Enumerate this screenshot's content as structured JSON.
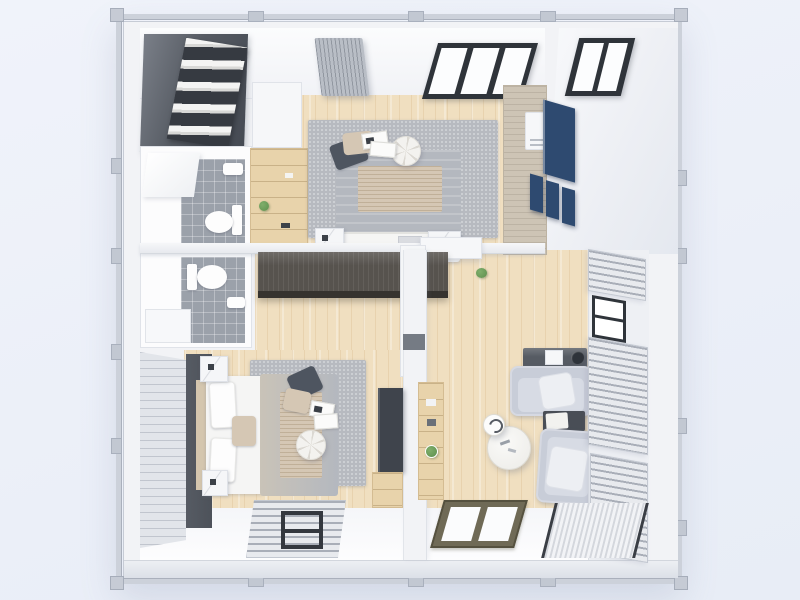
{
  "scene": {
    "title": "Top-view 3D floor plan render of a two-bedroom container home",
    "view": "top-down 3d architectural render, no visible text",
    "rooms": [
      {
        "id": "bedroom-1",
        "label": "Bedroom 1 (top)",
        "floor": "light wood planks",
        "furniture": [
          "double bed with gray duvet",
          "gray area rug",
          "round white pouf",
          "open magazines",
          "two nightstands",
          "white wall cabinet",
          "wood shelf unit with plant",
          "wood desk",
          "navy wall panel",
          "navy cube shelves",
          "white mini fridge",
          "ceiling AC unit",
          "dark-framed top window"
        ]
      },
      {
        "id": "walk-in-closet",
        "label": "Walk-in closet (top-left)",
        "furniture": [
          "dark wardrobe with folded white linens"
        ]
      },
      {
        "id": "bathroom-1",
        "label": "Bathroom 1 (upper-left)",
        "floor": "gray tile",
        "furniture": [
          "toilet",
          "wash basin",
          "open white door"
        ]
      },
      {
        "id": "bathroom-2",
        "label": "Bathroom 2 (mid-left)",
        "floor": "gray tile",
        "furniture": [
          "toilet",
          "wash basin",
          "shower tray"
        ]
      },
      {
        "id": "bedroom-2",
        "label": "Bedroom 2 (bottom-left)",
        "floor": "light wood planks",
        "furniture": [
          "double bed with white and gray bedding",
          "gray area rug",
          "round white pouf",
          "open magazines",
          "two marble-top nightstands",
          "dark accent headboard wall",
          "blinded window wall",
          "TV panel",
          "low wood cabinet",
          "striped floor mat with dark frame"
        ]
      },
      {
        "id": "living-room",
        "label": "Living room (bottom-right)",
        "floor": "light wood planks",
        "furniture": [
          "two facing light-gray loveseats",
          "dark side table with marble cushion",
          "round marble coffee table",
          "small round side table",
          "dark console table",
          "small white appliance",
          "dark planter pot",
          "wall shelf with green clock",
          "potted plant",
          "venetian-blind windows",
          "olive-framed floor window",
          "striped floor mat"
        ]
      },
      {
        "id": "hallway",
        "label": "Hallway (center)",
        "furniture": [
          "long dark wardrobe",
          "gray wall cabinet",
          "white column"
        ]
      }
    ],
    "openings": [
      "top wall dark-framed window (bedroom 1)",
      "top-right dark-framed window (exterior wall)",
      "right wall windows with venetian blinds (living room)",
      "left wall blinded window (bedroom 2)",
      "two bottom wall windows seen in perspective"
    ],
    "palette": {
      "background": "#edf1f9",
      "frame": "#ccd1da",
      "frame_dark": "#aab0bc",
      "wall_white": "#f3f4f7",
      "wood_floor": "#f0dfc0",
      "tile_gray": "#9ba1aa",
      "closet_dark": "#565b63",
      "wardrobe_dark": "#57534e",
      "accent_wall": "#4d525a",
      "navy": "#2e4a70",
      "rug_gray": "#b7bac0",
      "bed_gray": "#b4b8bf",
      "pillow_dark": "#4e5560",
      "pillow_beige": "#d5c7b4",
      "sofa_gray": "#c8cdd8",
      "blind_light": "#e8eaee",
      "blind_line": "#a9aeb8",
      "plant_green": "#5d8f4e"
    }
  }
}
